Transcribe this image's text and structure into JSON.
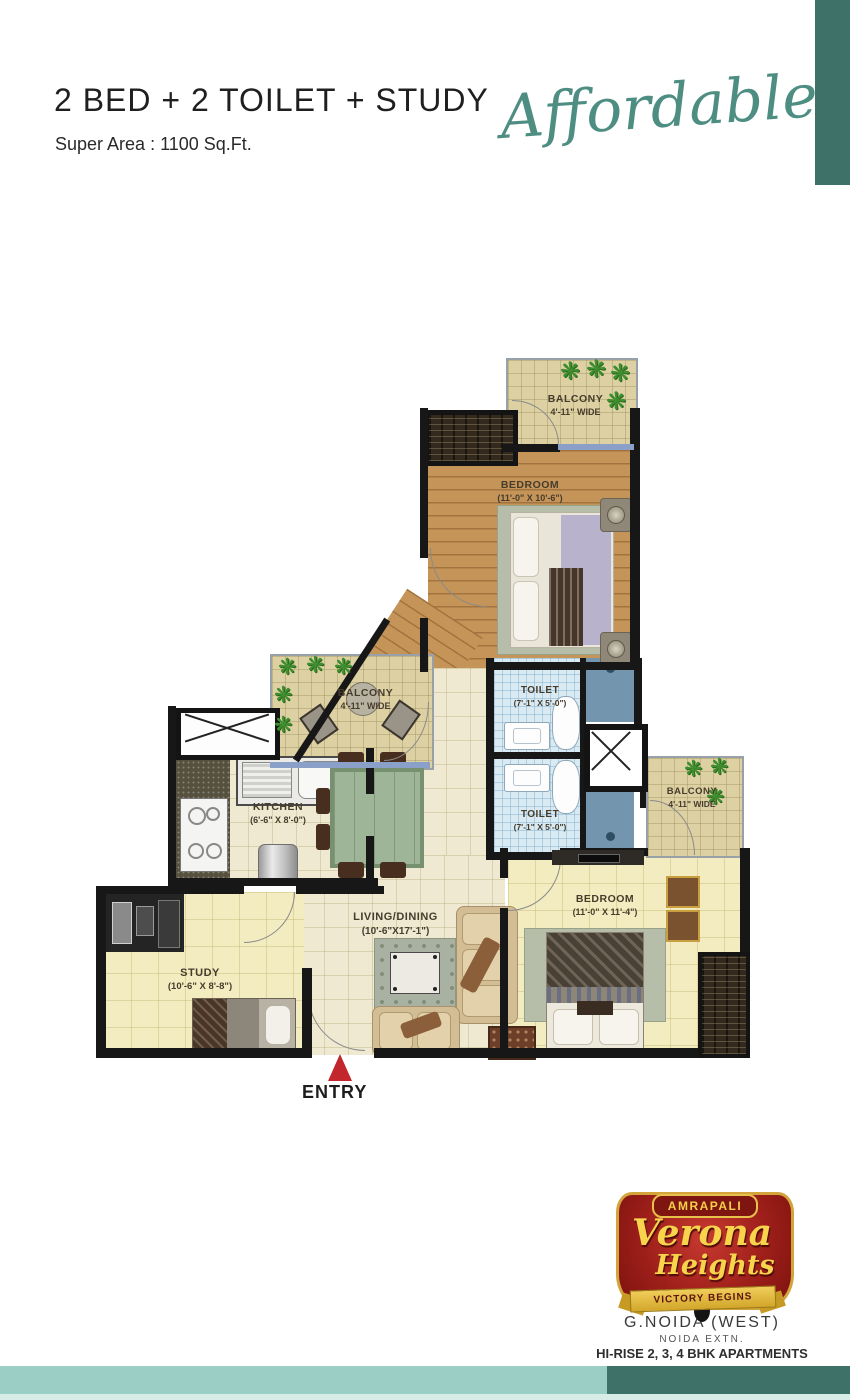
{
  "header": {
    "title": "2 BED + 2 TOILET + STUDY",
    "subtitle": "Super Area : 1100 Sq.Ft.",
    "script_word": "Affordable"
  },
  "plan": {
    "entry_label": "ENTRY",
    "rooms": [
      {
        "id": "balcony-top",
        "label": "BALCONY",
        "dims": "4'-11\" WIDE"
      },
      {
        "id": "bedroom-1",
        "label": "BEDROOM",
        "dims": "(11'-0\" X 10'-6\")"
      },
      {
        "id": "toilet-1",
        "label": "TOILET",
        "dims": "(7'-1\" X 5'-0\")"
      },
      {
        "id": "toilet-2",
        "label": "TOILET",
        "dims": "(7'-1\" X 5'-0\")"
      },
      {
        "id": "balcony-left",
        "label": "BALCONY",
        "dims": "4'-11\" WIDE"
      },
      {
        "id": "kitchen",
        "label": "KITCHEN",
        "dims": "(6'-6\" X 8'-0\")"
      },
      {
        "id": "living-dining",
        "label": "LIVING/DINING",
        "dims": "(10'-6\"X17'-1\")"
      },
      {
        "id": "study",
        "label": "STUDY",
        "dims": "(10'-6\" X 8'-8\")"
      },
      {
        "id": "bedroom-2",
        "label": "BEDROOM",
        "dims": "(11'-0\" X 11'-4\")"
      },
      {
        "id": "balcony-right",
        "label": "BALCONY",
        "dims": "4'-11\" WIDE"
      }
    ]
  },
  "footer": {
    "brand": "AMRAPALI",
    "project_line1": "Verona",
    "project_line2": "Heights",
    "tagline": "VICTORY BEGINS",
    "location1": "G.NOIDA (WEST)",
    "location2": "NOIDA EXTN.",
    "description": "HI-RISE 2, 3, 4 BHK APARTMENTS"
  },
  "icons": {
    "plant": "❋"
  },
  "colors": {
    "accent_dark_teal": "#3e7268",
    "accent_light_teal": "#9bcfc6",
    "script_teal": "#4e8e82",
    "entry_arrow_red": "#c1272d",
    "logo_red": "#9e1f1a",
    "logo_gold": "#f5d04a"
  }
}
